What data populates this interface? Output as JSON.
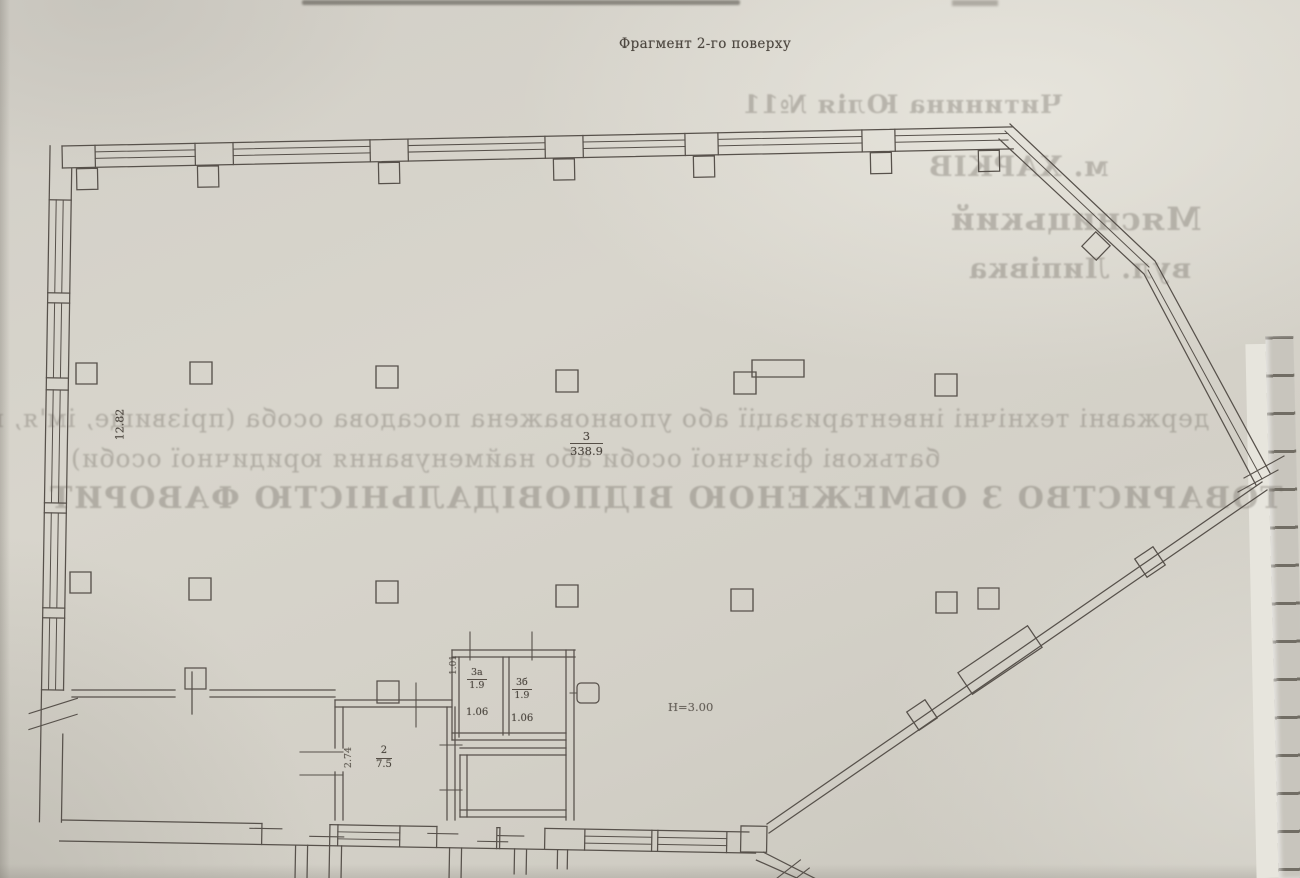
{
  "page": {
    "heading": "Фрагмент 2-го поверху"
  },
  "plan": {
    "left_dimension": "12.82",
    "hall": {
      "number": "3",
      "area": "338.9"
    },
    "ceiling_height": "Н=3.00",
    "wc_a": {
      "number": "3а",
      "area": "1.9",
      "width": "1.06"
    },
    "wc_b": {
      "number": "3б",
      "area": "1.9",
      "width": "1.06"
    },
    "door_dimension": "1.01",
    "stair_room": {
      "number": "2",
      "area": "7.5"
    },
    "stair_dimension": "2.74"
  },
  "bleedthrough": {
    "top": [
      "Читинина Юлія №11",
      "м. ХАРКІВ",
      "Мясницький",
      "вул. Липівка"
    ],
    "middle": [
      "державні технічні інвентаризації або уповноважена посадова особа (прізвище, ім'я, по",
      "батькові фізичної особи або найменування юридичної особи)",
      "ТОВАРИСТВО З ОБМЕЖЕНОЮ ВІДПОВІДАЛЬНІСТЮ  ФАВОРИТ"
    ]
  },
  "colors": {
    "paper": "#d6d3ca",
    "ink": "#57514b",
    "bleed_ink": "#68625 7"
  }
}
